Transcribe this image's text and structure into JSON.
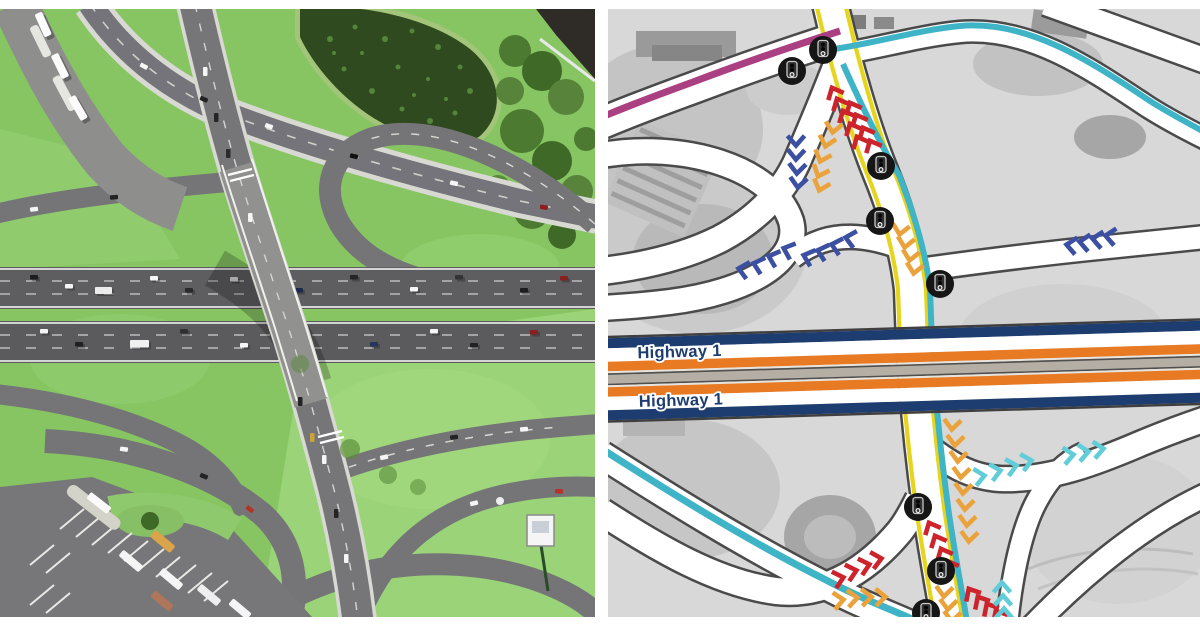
{
  "panels": {
    "left": {
      "type": "aerial-render",
      "colors": {
        "grass_green": "#87c563",
        "grass_light": "#9bd478",
        "road_gray": "#6f6f71",
        "highway_gray": "#5e5e60",
        "pond_dark": "#2e4a1e"
      }
    },
    "right": {
      "type": "traffic-flow-map",
      "labels": {
        "highway_top": "Highway 1",
        "highway_bottom": "Highway 1"
      },
      "colors": {
        "map_bg": "#d8d8d8",
        "road_white": "#ffffff",
        "road_outline": "#4a4a4a",
        "highway_navy": "#1d3c70",
        "highway_orange": "#e87a24",
        "median_gray": "#b5aea4",
        "route_yellow": "#e6d51f",
        "route_teal": "#3fb4c6",
        "route_magenta": "#aa3f82",
        "chevron_red": "#cd242c",
        "chevron_blue": "#3c50a2",
        "chevron_orange": "#eaa33c",
        "chevron_teal": "#62cdd8",
        "signal_black": "#161616"
      },
      "icons": {
        "traffic_signal": "traffic-signal-icon",
        "traffic_signal_count": 8,
        "chevron": "chevron-arrow-icon"
      }
    }
  }
}
